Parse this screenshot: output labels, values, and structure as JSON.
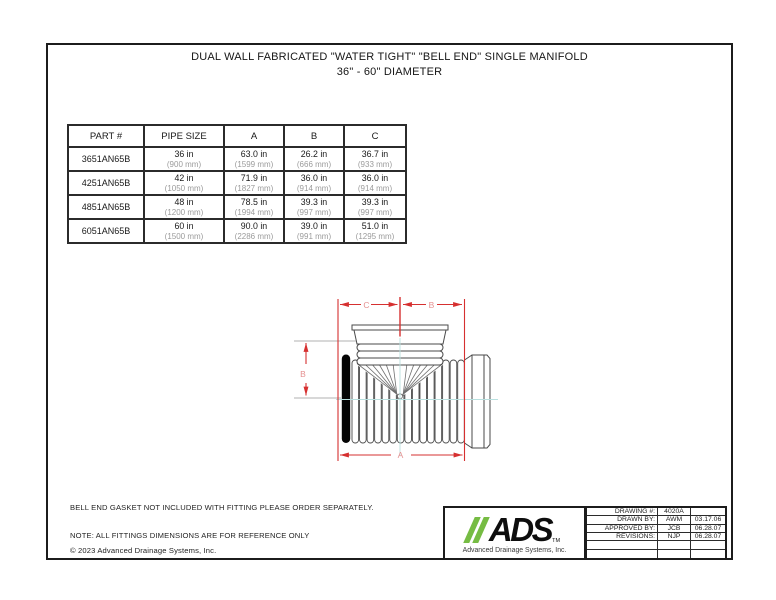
{
  "title": {
    "line1": "DUAL WALL FABRICATED \"WATER TIGHT\" \"BELL END\" SINGLE MANIFOLD",
    "line2": "36\" - 60\" DIAMETER"
  },
  "spec_table": {
    "headers": [
      "PART #",
      "PIPE SIZE",
      "A",
      "B",
      "C"
    ],
    "rows": [
      {
        "part": "3651AN65B",
        "cells": [
          [
            "36 in",
            "(900 mm)"
          ],
          [
            "63.0 in",
            "(1599 mm)"
          ],
          [
            "26.2 in",
            "(666 mm)"
          ],
          [
            "36.7 in",
            "(933 mm)"
          ]
        ]
      },
      {
        "part": "4251AN65B",
        "cells": [
          [
            "42 in",
            "(1050 mm)"
          ],
          [
            "71.9 in",
            "(1827 mm)"
          ],
          [
            "36.0 in",
            "(914 mm)"
          ],
          [
            "36.0 in",
            "(914 mm)"
          ]
        ]
      },
      {
        "part": "4851AN65B",
        "cells": [
          [
            "48 in",
            "(1200 mm)"
          ],
          [
            "78.5 in",
            "(1994 mm)"
          ],
          [
            "39.3 in",
            "(997 mm)"
          ],
          [
            "39.3 in",
            "(997 mm)"
          ]
        ]
      },
      {
        "part": "6051AN65B",
        "cells": [
          [
            "60 in",
            "(1500 mm)"
          ],
          [
            "90.0 in",
            "(2286 mm)"
          ],
          [
            "39.0 in",
            "(991 mm)"
          ],
          [
            "51.0 in",
            "(1295 mm)"
          ]
        ]
      }
    ]
  },
  "diagram": {
    "dim_labels": {
      "top_left": "C",
      "top_right": "B",
      "left": "B",
      "bottom": "A"
    },
    "colors": {
      "dimension_line": "#d63030",
      "dimension_label": "#e59090",
      "centerline": "#b9e0df",
      "outline": "#4a4a4a",
      "gasket": "#050505"
    }
  },
  "notes": {
    "gasket": "BELL END GASKET NOT INCLUDED WITH FITTING PLEASE ORDER SEPARATELY.",
    "reference": "NOTE: ALL FITTINGS DIMENSIONS ARE FOR REFERENCE ONLY",
    "copyright": "© 2023 Advanced Drainage Systems, Inc."
  },
  "title_block": {
    "logo": {
      "text": "ADS",
      "tm": "TM",
      "caption": "Advanced Drainage Systems, Inc.",
      "green": "#76bc43"
    },
    "rows": [
      {
        "label": "DRAWING #:",
        "value": "4020A",
        "date": ""
      },
      {
        "label": "DRAWN BY:",
        "value": "AWM",
        "date": "03.17.06"
      },
      {
        "label": "APPROVED BY:",
        "value": "JCB",
        "date": "06.28.07"
      },
      {
        "label": "REVISIONS:",
        "value": "NJP",
        "date": "06.28.07"
      },
      {
        "label": "",
        "value": "",
        "date": ""
      },
      {
        "label": "",
        "value": "",
        "date": ""
      }
    ]
  }
}
